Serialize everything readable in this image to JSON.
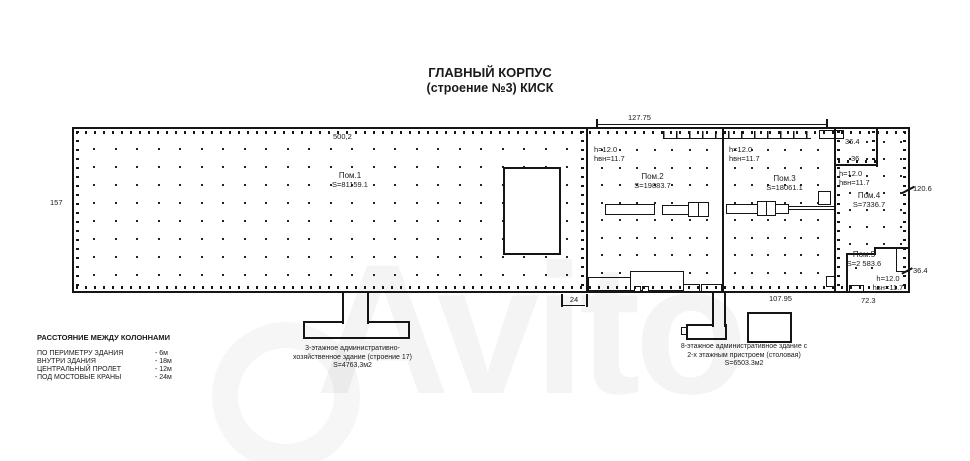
{
  "title": {
    "line1": "ГЛАВНЫЙ КОРПУС",
    "line2": "(строение №3) КИСК"
  },
  "watermark": {
    "text": "Avito"
  },
  "dims": {
    "top_width": "500,2",
    "left_height": "157",
    "top_section": "127.75",
    "notch_width": "36.4",
    "notch_height": "36",
    "right_height": "120.6",
    "pom5_height": "36.4",
    "pom5_width": "72.3",
    "bottom_section": "107.95",
    "bay_gap": "24"
  },
  "rooms": {
    "r1": {
      "name": "Пом.1",
      "area": "S=81159.1"
    },
    "r2": {
      "name": "Пом.2",
      "area": "S=19883.7",
      "h": "h=12.0",
      "hvn": "hвн=11.7"
    },
    "r3": {
      "name": "Пом.3",
      "area": "S=18061.1",
      "h": "h=12.0",
      "hvn": "hвн=11.7"
    },
    "r4": {
      "name": "Пом.4",
      "area": "S=7336.7",
      "h": "h=12.0",
      "hvn": "hвн=11.7"
    },
    "r5": {
      "name": "Пом.5",
      "area": "S=2 583.6",
      "h": "h=12.0",
      "hvn": "hвн=11.7"
    }
  },
  "annotations": {
    "left": {
      "line1": "3-этажное административно-",
      "line2": "хозяйственное здание (строение 17)",
      "line3": "S=4763,3м2"
    },
    "right": {
      "line1": "8-этажное административное здание с",
      "line2": "2-х этажным пристроем (столовая)",
      "line3": "S=6503.3м2"
    }
  },
  "legend": {
    "title": "РАССТОЯНИЕ МЕЖДУ КОЛОННАМИ",
    "items": [
      {
        "label": "ПО ПЕРИМЕТРУ ЗДАНИЯ",
        "value": "- 6м"
      },
      {
        "label": "ВНУТРИ ЗДАНИЯ",
        "value": "- 18м"
      },
      {
        "label": "ЦЕНТРАЛЬНЫЙ ПРОЛЕТ",
        "value": "- 12м"
      },
      {
        "label": "ПОД МОСТОВЫЕ КРАНЫ",
        "value": "- 24м"
      }
    ]
  },
  "colors": {
    "line": "#1a1a1a",
    "watermark": "rgba(0,0,0,0.045)"
  }
}
